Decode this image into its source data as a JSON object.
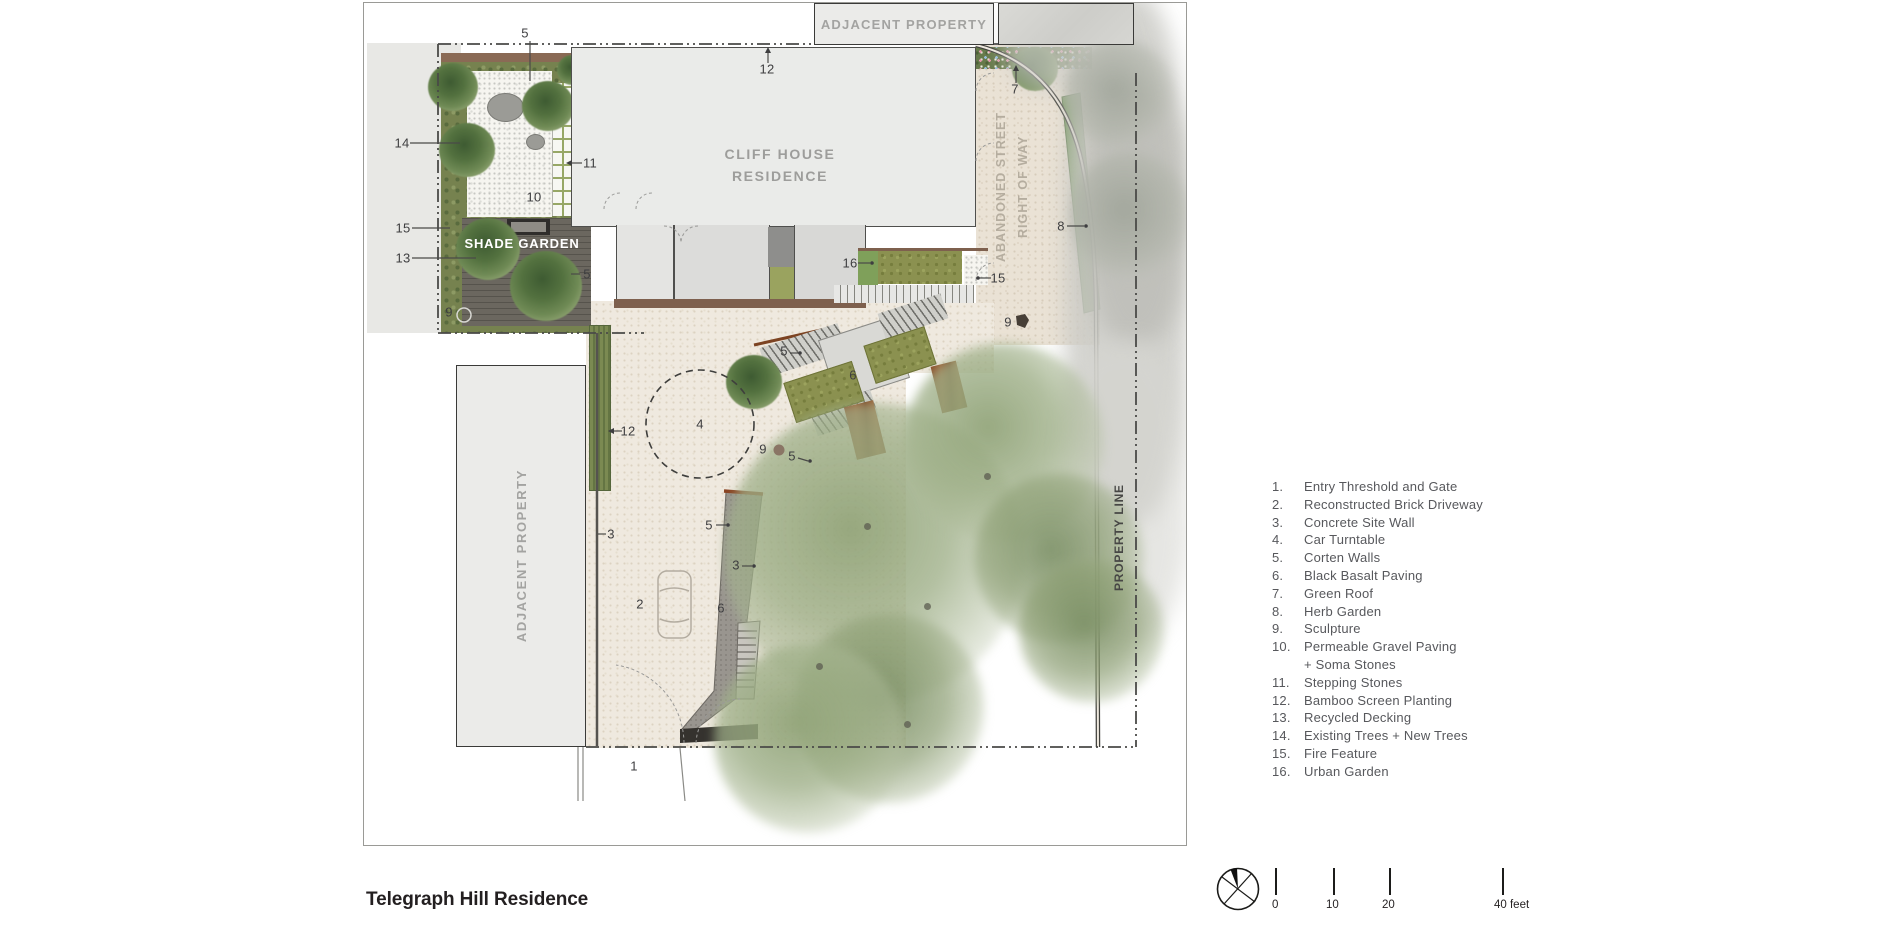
{
  "title": "Telegraph Hill Residence",
  "plan": {
    "labels": {
      "adjacent_property_top": "ADJACENT PROPERTY",
      "adjacent_property_left": "ADJACENT PROPERTY",
      "cliff_house_line1": "CLIFF HOUSE",
      "cliff_house_line2": "RESIDENCE",
      "shade_garden": "SHADE GARDEN",
      "abandoned_street_line1": "ABANDONED STREET",
      "abandoned_street_line2": "RIGHT OF WAY",
      "property_line": "PROPERTY LINE"
    },
    "callouts": [
      {
        "n": "5",
        "x": 161,
        "y": 30
      },
      {
        "n": "12",
        "x": 403,
        "y": 66
      },
      {
        "n": "7",
        "x": 651,
        "y": 86
      },
      {
        "n": "14",
        "x": 38,
        "y": 140
      },
      {
        "n": "11",
        "x": 226,
        "y": 160
      },
      {
        "n": "10",
        "x": 170,
        "y": 194
      },
      {
        "n": "15",
        "x": 39,
        "y": 225
      },
      {
        "n": "13",
        "x": 39,
        "y": 255
      },
      {
        "n": "5",
        "x": 223,
        "y": 271
      },
      {
        "n": "16",
        "x": 486,
        "y": 260
      },
      {
        "n": "15",
        "x": 634,
        "y": 275
      },
      {
        "n": "8",
        "x": 697,
        "y": 223
      },
      {
        "n": "9",
        "x": 85,
        "y": 309
      },
      {
        "n": "9",
        "x": 644,
        "y": 319
      },
      {
        "n": "5",
        "x": 420,
        "y": 348
      },
      {
        "n": "6",
        "x": 489,
        "y": 372
      },
      {
        "n": "4",
        "x": 336,
        "y": 421
      },
      {
        "n": "12",
        "x": 264,
        "y": 428
      },
      {
        "n": "9",
        "x": 399,
        "y": 446
      },
      {
        "n": "5",
        "x": 428,
        "y": 453
      },
      {
        "n": "5",
        "x": 345,
        "y": 522
      },
      {
        "n": "3",
        "x": 247,
        "y": 531
      },
      {
        "n": "3",
        "x": 372,
        "y": 562
      },
      {
        "n": "2",
        "x": 276,
        "y": 601
      },
      {
        "n": "6",
        "x": 357,
        "y": 605
      },
      {
        "n": "1",
        "x": 270,
        "y": 763
      }
    ]
  },
  "legend": {
    "items": [
      {
        "n": "1.",
        "text": "Entry Threshold and Gate"
      },
      {
        "n": "2.",
        "text": "Reconstructed Brick Driveway"
      },
      {
        "n": "3.",
        "text": "Concrete Site Wall"
      },
      {
        "n": "4.",
        "text": "Car Turntable"
      },
      {
        "n": "5.",
        "text": "Corten Walls"
      },
      {
        "n": "6.",
        "text": "Black Basalt Paving"
      },
      {
        "n": "7.",
        "text": "Green Roof"
      },
      {
        "n": "8.",
        "text": "Herb Garden"
      },
      {
        "n": "9.",
        "text": "Sculpture"
      },
      {
        "n": "10.",
        "text": "Permeable Gravel Paving",
        "text2": "+ Soma Stones"
      },
      {
        "n": "11.",
        "text": "Stepping Stones"
      },
      {
        "n": "12.",
        "text": "Bamboo Screen Planting"
      },
      {
        "n": "13.",
        "text": "Recycled Decking"
      },
      {
        "n": "14.",
        "text": "Existing Trees +  New Trees"
      },
      {
        "n": "15.",
        "text": "Fire Feature"
      },
      {
        "n": "16.",
        "text": "Urban Garden"
      }
    ]
  },
  "scale_bar": {
    "labels": [
      "0",
      "10",
      "20",
      "40 feet"
    ]
  },
  "north_arrow_icon": "north-arrow-compass",
  "colors": {
    "ink": "#3e3e40",
    "legend_text": "#57585c",
    "muted_label": "#9d9d9b",
    "paving_beige": "#efe9df",
    "olive_planting": "#8b9150",
    "corten": "#91502c",
    "basalt": "#99958f",
    "deck": "#67635c",
    "tree_sage": "#9fae8a"
  }
}
